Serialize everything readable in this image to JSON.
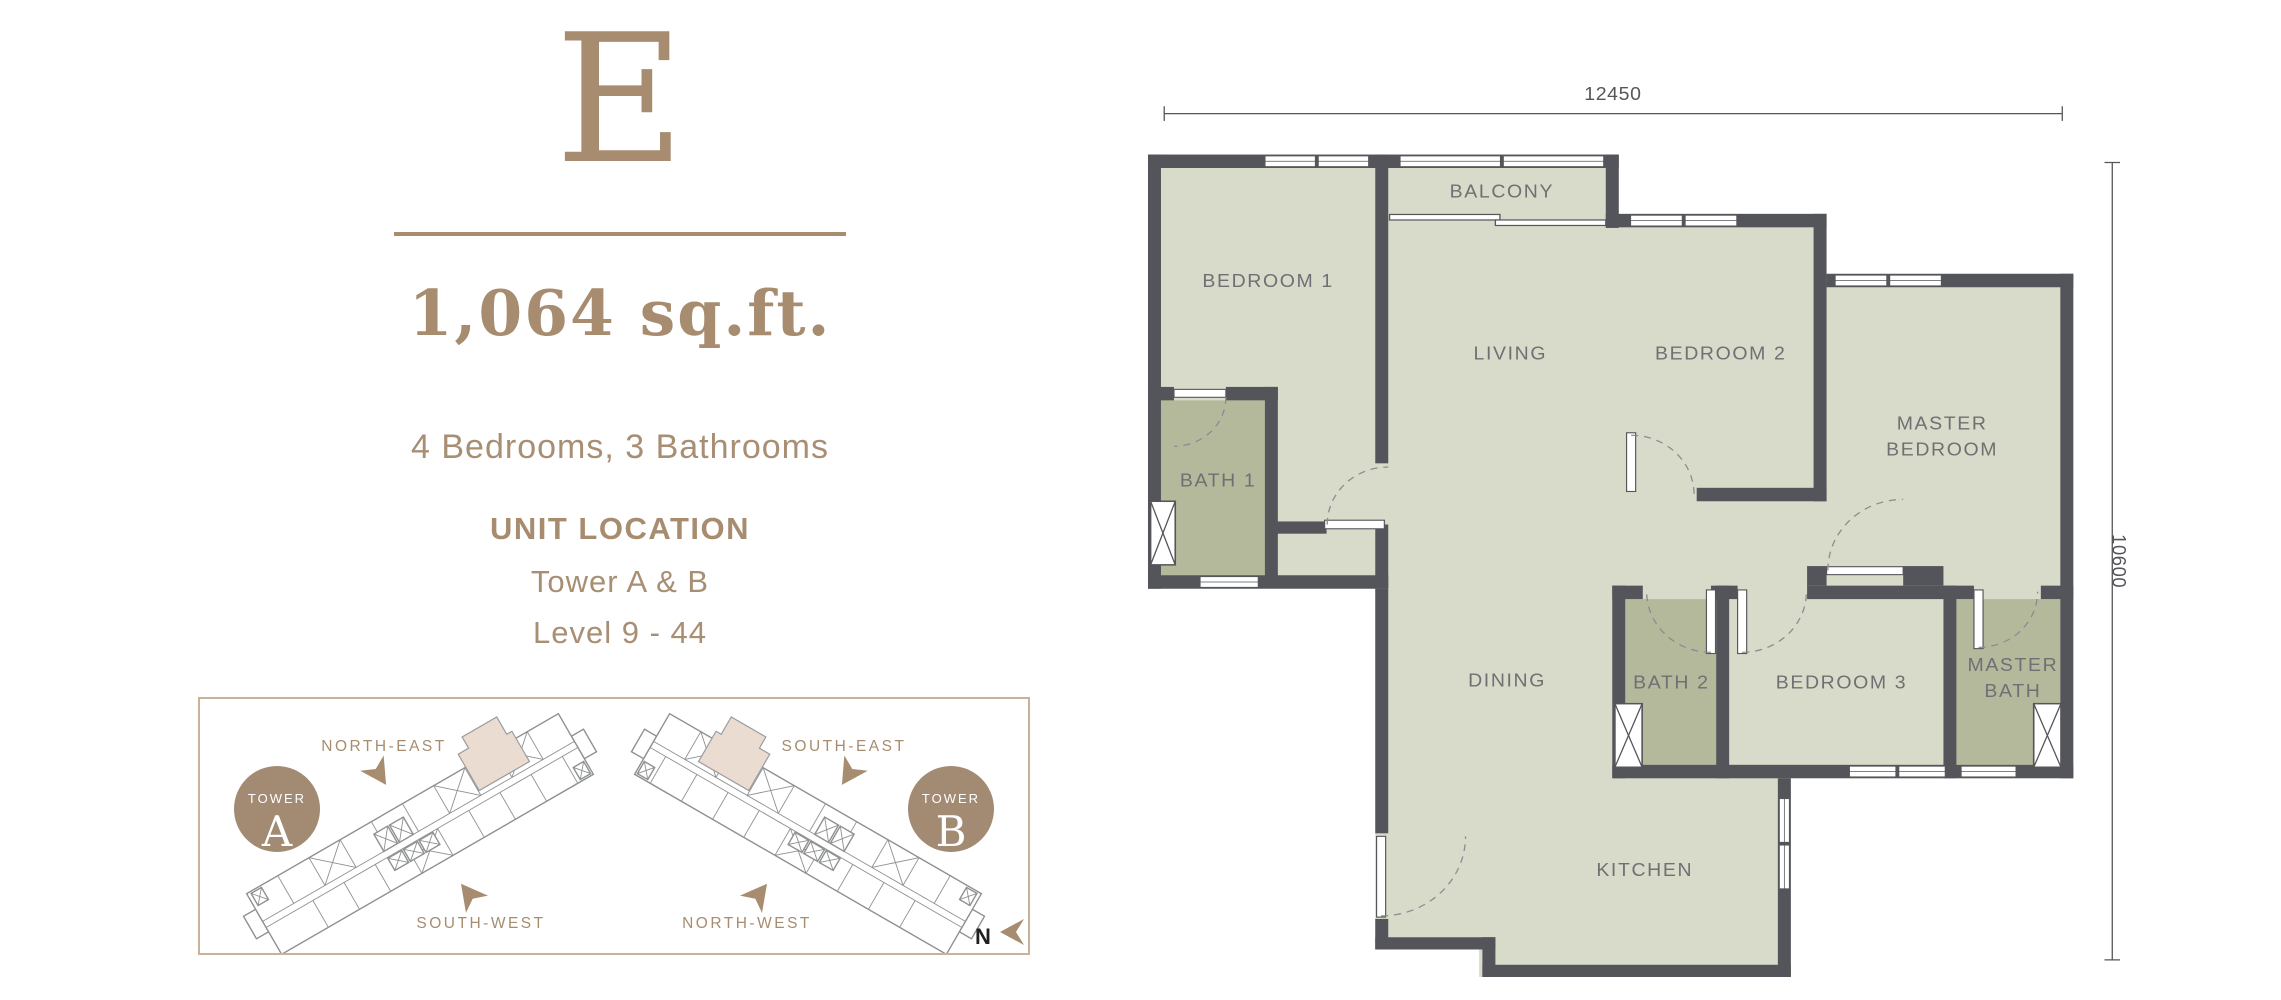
{
  "unit": {
    "type_label": "E",
    "area": "1,064 sq.ft.",
    "config": "4 Bedrooms, 3 Bathrooms"
  },
  "location": {
    "heading": "UNIT LOCATION",
    "towers": "Tower A & B",
    "levels": "Level 9 - 44"
  },
  "towerbox": {
    "tower_a": {
      "badge_word": "TOWER",
      "letter": "A",
      "dir_top": "NORTH-EAST",
      "dir_bottom": "SOUTH-WEST"
    },
    "tower_b": {
      "badge_word": "TOWER",
      "letter": "B",
      "dir_top": "SOUTH-EAST",
      "dir_bottom": "NORTH-WEST"
    },
    "compass": "N"
  },
  "plan": {
    "dims": {
      "width": "12450",
      "height": "10600"
    },
    "rooms": {
      "bedroom1": "BEDROOM 1",
      "balcony": "BALCONY",
      "living": "LIVING",
      "bedroom2": "BEDROOM 2",
      "master1": "MASTER",
      "master2": "BEDROOM",
      "bath1": "BATH 1",
      "dining": "DINING",
      "bath2": "BATH 2",
      "bedroom3": "BEDROOM 3",
      "mbath1": "MASTER",
      "mbath2": "BATH",
      "kitchen": "KITCHEN"
    }
  },
  "colors": {
    "accent_tan": "#A78C70",
    "tower_circle": "#A28A73",
    "box_border": "#C9B299",
    "wall": "#54555A",
    "room_fill": "#D8DBC9",
    "bath_fill": "#B5B99C",
    "highlight_unit": "#EADCD1",
    "room_label": "#6F7074"
  }
}
